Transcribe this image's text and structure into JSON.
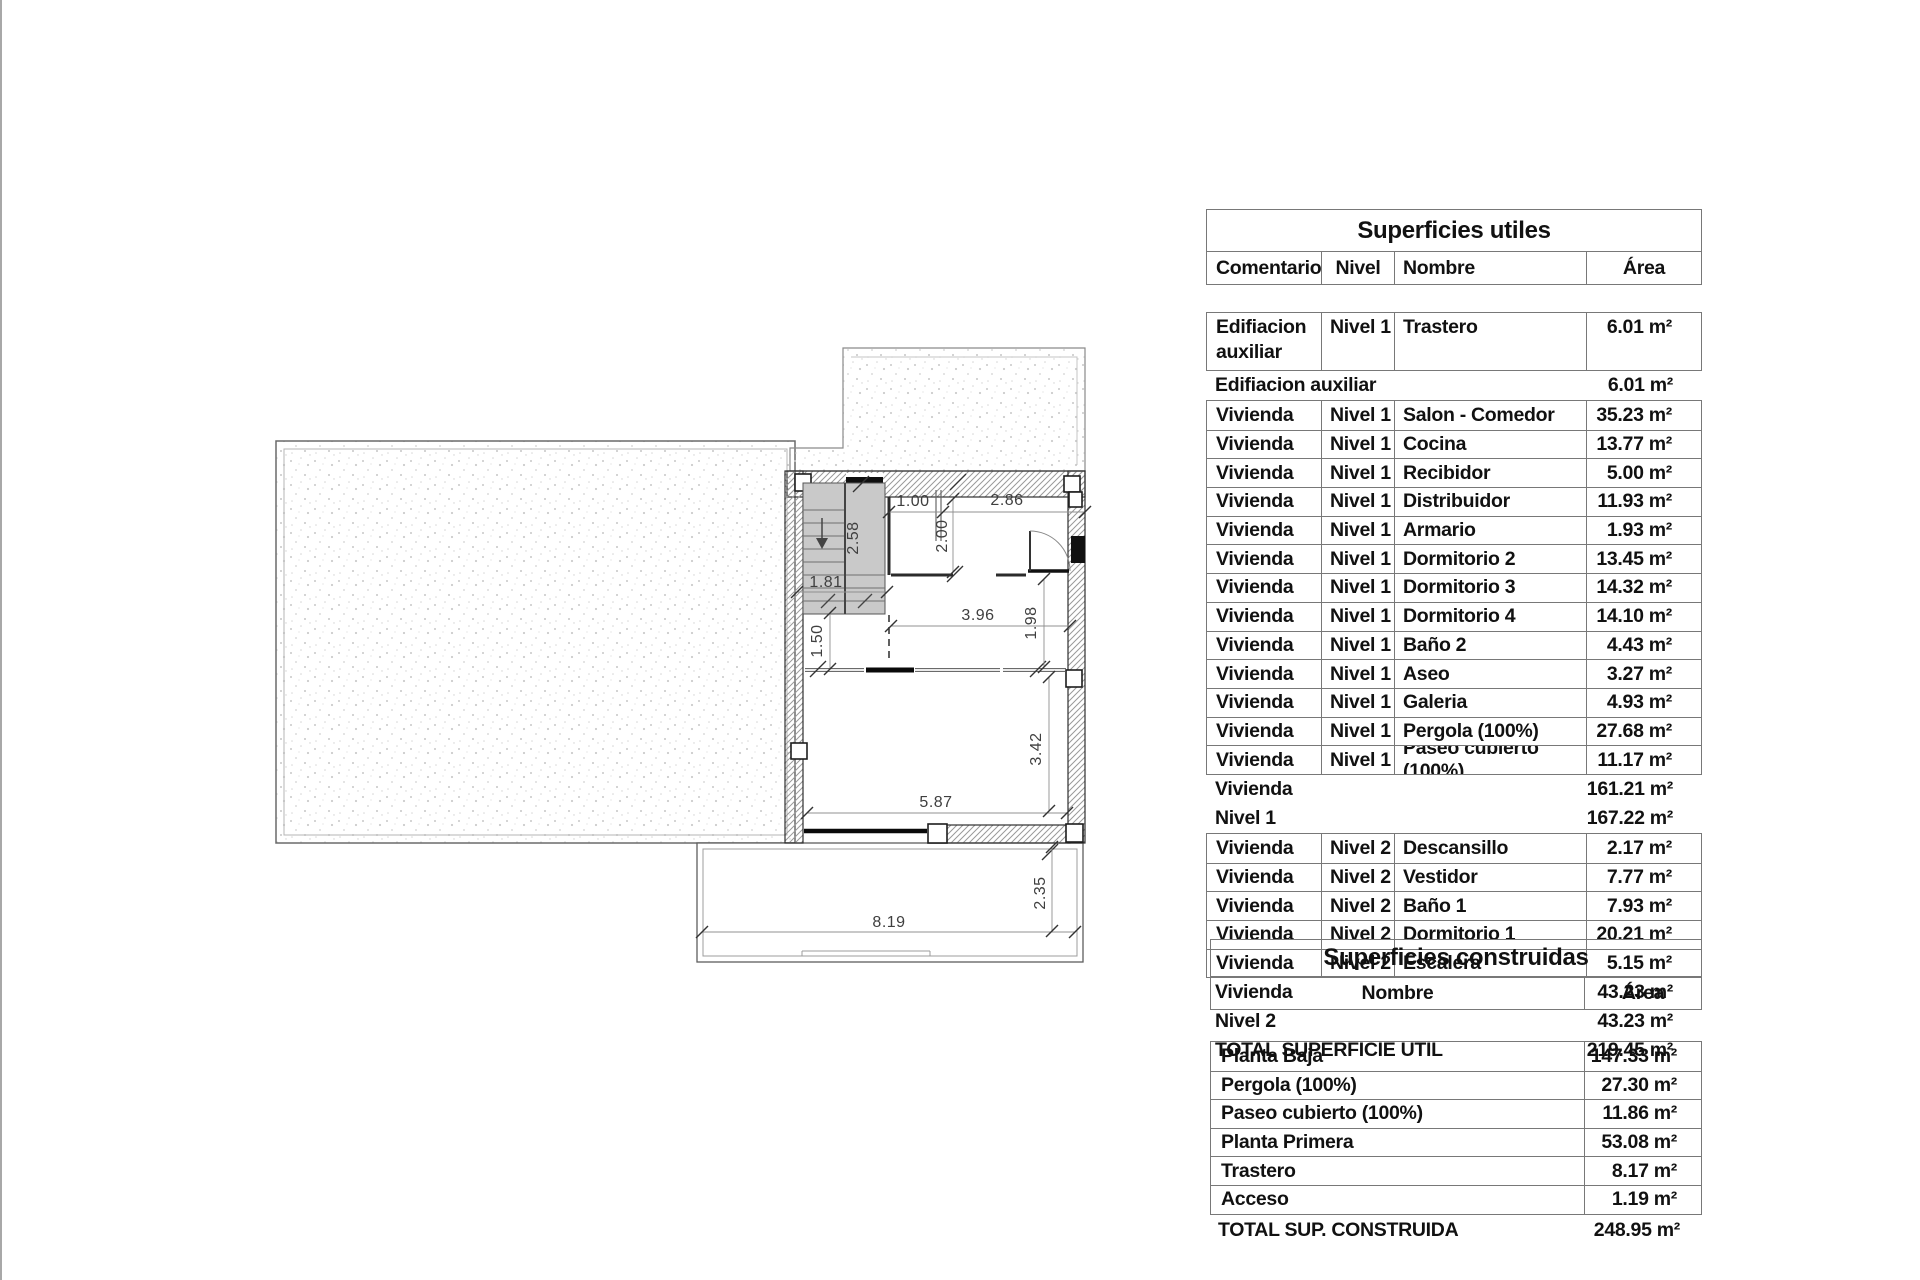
{
  "colors": {
    "table_border": "#787878",
    "text": "#111111",
    "stair_fill": "#c9c9c9",
    "wall_hatch": "#999999",
    "dim_text": "#3f3f3f"
  },
  "floor_plan": {
    "dims": {
      "d100": "1.00",
      "d286": "2.86",
      "d200": "2.00",
      "d258": "2.58",
      "d181": "1.81",
      "d150": "1.50",
      "d396": "3.96",
      "d198": "1.98",
      "d342": "3.42",
      "d587": "5.87",
      "d819": "8.19",
      "d235": "2.35"
    }
  },
  "table_utiles": {
    "title": "Superficies utiles",
    "columns": [
      "Comentarios",
      "Nivel",
      "Nombre",
      "Área"
    ],
    "rows": [
      {
        "type": "data2",
        "comentarios": "Edifiacion auxiliar",
        "nivel": "Nivel 1",
        "nombre": "Trastero",
        "area": "6.01 m²"
      },
      {
        "type": "subtotal",
        "label": "Edifiacion auxiliar",
        "value": "6.01 m²"
      },
      {
        "type": "data",
        "comentarios": "Vivienda",
        "nivel": "Nivel 1",
        "nombre": "Salon - Comedor",
        "area": "35.23 m²"
      },
      {
        "type": "data",
        "comentarios": "Vivienda",
        "nivel": "Nivel 1",
        "nombre": "Cocina",
        "area": "13.77 m²"
      },
      {
        "type": "data",
        "comentarios": "Vivienda",
        "nivel": "Nivel 1",
        "nombre": "Recibidor",
        "area": "5.00 m²"
      },
      {
        "type": "data",
        "comentarios": "Vivienda",
        "nivel": "Nivel 1",
        "nombre": "Distribuidor",
        "area": "11.93 m²"
      },
      {
        "type": "data",
        "comentarios": "Vivienda",
        "nivel": "Nivel 1",
        "nombre": "Armario",
        "area": "1.93 m²"
      },
      {
        "type": "data",
        "comentarios": "Vivienda",
        "nivel": "Nivel 1",
        "nombre": "Dormitorio 2",
        "area": "13.45 m²"
      },
      {
        "type": "data",
        "comentarios": "Vivienda",
        "nivel": "Nivel 1",
        "nombre": "Dormitorio 3",
        "area": "14.32 m²"
      },
      {
        "type": "data",
        "comentarios": "Vivienda",
        "nivel": "Nivel 1",
        "nombre": "Dormitorio 4",
        "area": "14.10 m²"
      },
      {
        "type": "data",
        "comentarios": "Vivienda",
        "nivel": "Nivel 1",
        "nombre": "Baño 2",
        "area": "4.43 m²"
      },
      {
        "type": "data",
        "comentarios": "Vivienda",
        "nivel": "Nivel 1",
        "nombre": "Aseo",
        "area": "3.27 m²"
      },
      {
        "type": "data",
        "comentarios": "Vivienda",
        "nivel": "Nivel 1",
        "nombre": "Galeria",
        "area": "4.93 m²"
      },
      {
        "type": "data",
        "comentarios": "Vivienda",
        "nivel": "Nivel 1",
        "nombre": "Pergola (100%)",
        "area": "27.68 m²"
      },
      {
        "type": "data",
        "comentarios": "Vivienda",
        "nivel": "Nivel 1",
        "nombre": "Paseo cubierto (100%)",
        "area": "11.17 m²"
      },
      {
        "type": "subtotal",
        "label": "Vivienda",
        "value": "161.21 m²"
      },
      {
        "type": "subtotal",
        "label": "Nivel 1",
        "value": "167.22 m²"
      },
      {
        "type": "data",
        "comentarios": "Vivienda",
        "nivel": "Nivel 2",
        "nombre": "Descansillo",
        "area": "2.17 m²"
      },
      {
        "type": "data",
        "comentarios": "Vivienda",
        "nivel": "Nivel 2",
        "nombre": "Vestidor",
        "area": "7.77 m²"
      },
      {
        "type": "data",
        "comentarios": "Vivienda",
        "nivel": "Nivel 2",
        "nombre": "Baño 1",
        "area": "7.93 m²"
      },
      {
        "type": "data",
        "comentarios": "Vivienda",
        "nivel": "Nivel 2",
        "nombre": "Dormitorio 1",
        "area": "20.21 m²"
      },
      {
        "type": "data",
        "comentarios": "Vivienda",
        "nivel": "Nivel 2",
        "nombre": "Escalera",
        "area": "5.15 m²"
      },
      {
        "type": "subtotal",
        "label": "Vivienda",
        "value": "43.23 m²"
      },
      {
        "type": "subtotal",
        "label": "Nivel 2",
        "value": "43.23 m²"
      },
      {
        "type": "total",
        "label": "TOTAL SUPERFICIE UTIL",
        "value": "219.45 m²"
      }
    ]
  },
  "table_construidas": {
    "title": "Superficies construidas",
    "columns": [
      "Nombre",
      "Área"
    ],
    "rows": [
      {
        "nombre": "Planta Baja",
        "area": "147.33 m²"
      },
      {
        "nombre": "Pergola (100%)",
        "area": "27.30 m²"
      },
      {
        "nombre": "Paseo cubierto (100%)",
        "area": "11.86 m²"
      },
      {
        "nombre": "Planta Primera",
        "area": "53.08 m²"
      },
      {
        "nombre": "Trastero",
        "area": "8.17 m²"
      },
      {
        "nombre": "Acceso",
        "area": "1.19 m²"
      }
    ],
    "total_label": "TOTAL SUP. CONSTRUIDA",
    "total_value": "248.95 m²"
  }
}
